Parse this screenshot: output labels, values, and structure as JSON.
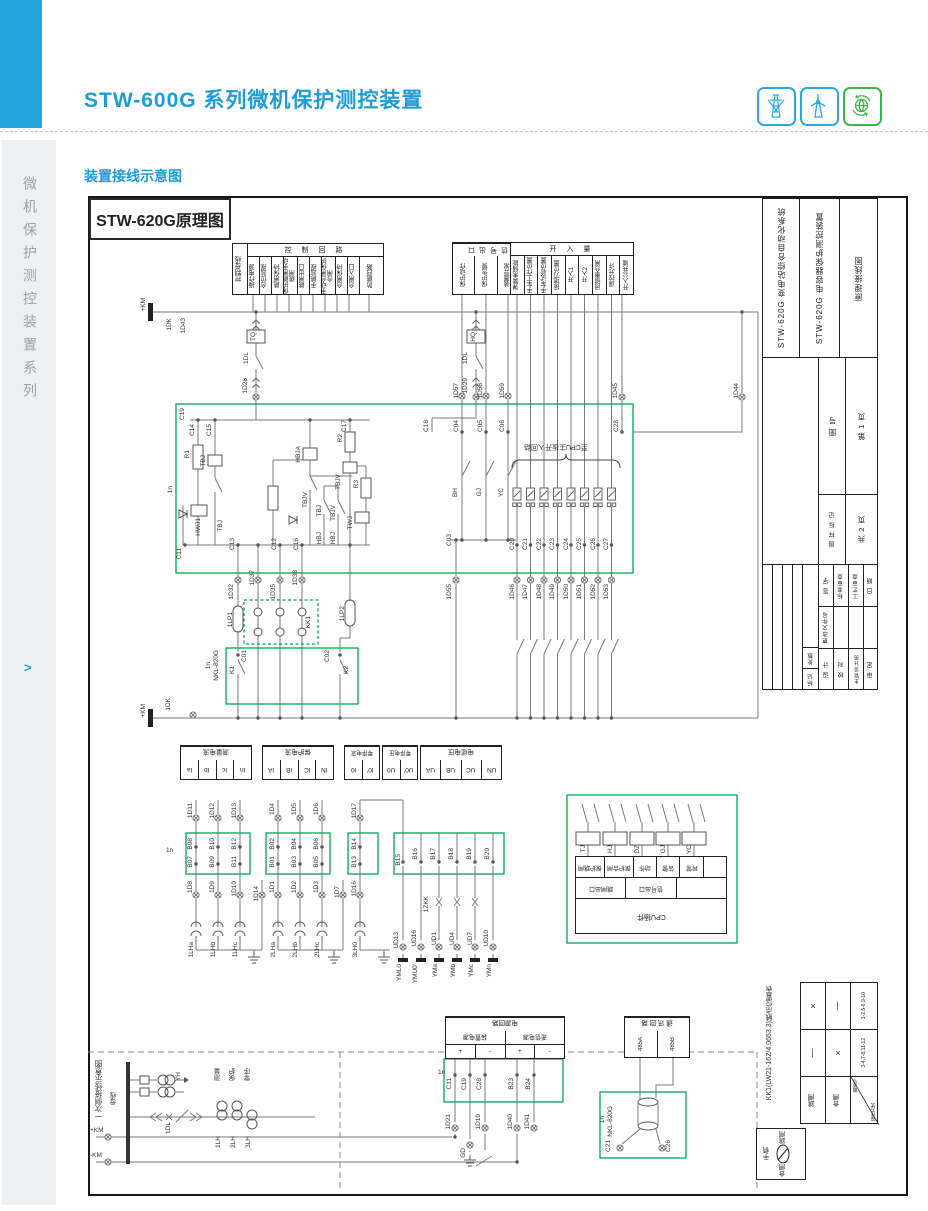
{
  "header": {
    "title": "STW-600G 系列微机保护测控装置",
    "section": "装置接线示意图",
    "sidebar": "微机保护测控装置系列",
    "sidebar_arrow": ">"
  },
  "diagram": {
    "title": "STW-620G原理图"
  },
  "ctrl_table": {
    "bus": "控制母线",
    "header": "控 制 回 路",
    "cols": [
      "操作电源",
      "合位监视",
      "跳闸保持",
      "保护跳闸手动跳闸",
      "跳闸出口",
      "手跳监视",
      "手动合闸保护合闸",
      "合闸保持",
      "合闸入口",
      "防跳回路"
    ]
  },
  "sig_table": {
    "header": "信号出口",
    "cols": [
      "保护动作",
      "保护告警",
      "装置异常"
    ]
  },
  "di_table": {
    "header": "开 入 量",
    "cols": [
      "弹簧未储能",
      "手车工作位置",
      "手车试验位置",
      "接地刀位置",
      "开入1",
      "开入2",
      "闭锁重合闸",
      "遥控允许",
      "开入公共端"
    ]
  },
  "analog_tables": [
    {
      "header": "测量电流",
      "cells": [
        "Ia",
        "Ib",
        "Ic",
        "In"
      ]
    },
    {
      "header": "保护电流",
      "cells": [
        "IA",
        "IB",
        "IC",
        "IN"
      ]
    },
    {
      "header": "零序电流",
      "cells": [
        "I0",
        "I0′"
      ]
    },
    {
      "header": "零序电压",
      "cells": [
        "U0",
        "U0′"
      ]
    },
    {
      "header": "电缆电压",
      "cells": [
        "UA",
        "UB",
        "UC",
        "UN"
      ]
    }
  ],
  "cpu_table": {
    "row1": [
      "保护跳闸",
      "保护合闸",
      "动作",
      "告警",
      "异常",
      ""
    ],
    "row2": [
      "跳闸出口",
      "信号出口",
      ""
    ],
    "row3": "CPU插件",
    "coils": [
      "TJ",
      "HJ",
      "DZ",
      "GJ",
      "YC"
    ],
    "note": "至CPU主板开入回路"
  },
  "power_table": {
    "header": "电源回路",
    "sub": [
      "装置电源",
      "遥信电源"
    ],
    "cells": [
      "+",
      "-",
      "+",
      "-"
    ]
  },
  "comm_table": {
    "header": "通 讯 回 路",
    "cells": [
      "485A",
      "485B"
    ]
  },
  "kk1": {
    "title": "KK1(LW21-16Z/4.0653.3)触点位置表",
    "contact_headers": [
      "1-2,5-6,9-10",
      "3-4,7-8,11-12"
    ],
    "marks": [
      [
        "×",
        "—"
      ],
      [
        "—",
        "×"
      ]
    ],
    "corner": [
      "触点号",
      "操作方式"
    ],
    "ops": [
      "跳闸",
      "合闸"
    ],
    "handle": [
      "跳闸",
      "合闸",
      "手柄"
    ]
  },
  "primary": {
    "title": "一次侧接线示意图",
    "bus": "母线",
    "pt": "YH",
    "breaker": "1DL",
    "groups": [
      "测量",
      "保护",
      "零序"
    ],
    "cts": [
      "1LH",
      "2LH",
      "3LH"
    ]
  },
  "titleblock": {
    "system": "STW-620G 变电站综合自动化系统",
    "device": "STW-620G 电容器保护测控装置",
    "doc": "原理接线图",
    "fig_no": "图  号",
    "page": "第 1 页",
    "mark": "图 样 标 记",
    "pages": "共 2 页",
    "sign": "签 字",
    "std": "标准审查",
    "craft": "工艺审查",
    "date2": "日 期",
    "change": "更改文件号",
    "count": "处数",
    "tag": "标记",
    "design": "设 计",
    "check": "校 对",
    "chief": "主管设计员",
    "approve": "审 定"
  },
  "labels": [
    {
      "t": "+KM",
      "x": 141,
      "y": 298,
      "r": 1
    },
    {
      "t": "1DK",
      "x": 167,
      "y": 318,
      "r": 1
    },
    {
      "t": "1D43",
      "x": 181,
      "y": 318,
      "r": 1
    },
    {
      "t": "TQ",
      "x": 251,
      "y": 332,
      "r": 1
    },
    {
      "t": "1DL",
      "x": 244,
      "y": 352,
      "r": 1
    },
    {
      "t": "1D26",
      "x": 243,
      "y": 378,
      "r": 1
    },
    {
      "t": "HQ",
      "x": 471,
      "y": 332,
      "r": 1
    },
    {
      "t": "1DL",
      "x": 463,
      "y": 352,
      "r": 1
    },
    {
      "t": "1D29",
      "x": 463,
      "y": 378,
      "r": 1
    },
    {
      "t": "1D57",
      "x": 454,
      "y": 383,
      "r": 1
    },
    {
      "t": "1D58",
      "x": 478,
      "y": 383,
      "r": 1
    },
    {
      "t": "1D59",
      "x": 500,
      "y": 383,
      "r": 1
    },
    {
      "t": "1D45",
      "x": 613,
      "y": 383,
      "r": 1
    },
    {
      "t": "1D44",
      "x": 734,
      "y": 383,
      "r": 1
    },
    {
      "t": "C19",
      "x": 180,
      "y": 408,
      "r": 1
    },
    {
      "t": "C14",
      "x": 190,
      "y": 424,
      "r": 1
    },
    {
      "t": "C15",
      "x": 207,
      "y": 424,
      "r": 1
    },
    {
      "t": "C18",
      "x": 424,
      "y": 420,
      "r": 1
    },
    {
      "t": "C17",
      "x": 342,
      "y": 420,
      "r": 1
    },
    {
      "t": "C04",
      "x": 454,
      "y": 420,
      "r": 1
    },
    {
      "t": "C05",
      "x": 478,
      "y": 420,
      "r": 1
    },
    {
      "t": "C06",
      "x": 500,
      "y": 420,
      "r": 1
    },
    {
      "t": "C28",
      "x": 614,
      "y": 420,
      "r": 1
    },
    {
      "t": "1n",
      "x": 168,
      "y": 486,
      "r": 1
    },
    {
      "t": "R1",
      "x": 185,
      "y": 450,
      "r": 1
    },
    {
      "t": "TBJ",
      "x": 201,
      "y": 455,
      "r": 1
    },
    {
      "t": "HWJ1",
      "x": 196,
      "y": 518,
      "r": 1
    },
    {
      "t": "TBJ",
      "x": 218,
      "y": 520,
      "r": 1
    },
    {
      "t": "HBJA",
      "x": 296,
      "y": 446,
      "r": 1
    },
    {
      "t": "R2",
      "x": 338,
      "y": 434,
      "r": 1
    },
    {
      "t": "TBJV",
      "x": 336,
      "y": 474,
      "r": 1
    },
    {
      "t": "TBJV",
      "x": 303,
      "y": 492,
      "r": 1
    },
    {
      "t": "R3",
      "x": 354,
      "y": 480,
      "r": 1
    },
    {
      "t": "TWJ",
      "x": 348,
      "y": 516,
      "r": 1
    },
    {
      "t": "TBJ",
      "x": 317,
      "y": 505,
      "r": 1
    },
    {
      "t": "TBJV",
      "x": 331,
      "y": 505,
      "r": 1
    },
    {
      "t": "HBJ",
      "x": 317,
      "y": 532,
      "r": 1
    },
    {
      "t": "HBJ",
      "x": 331,
      "y": 532,
      "r": 1
    },
    {
      "t": "C13",
      "x": 230,
      "y": 538,
      "r": 1
    },
    {
      "t": "C12",
      "x": 272,
      "y": 538,
      "r": 1
    },
    {
      "t": "C16",
      "x": 294,
      "y": 538,
      "r": 1
    },
    {
      "t": "C11",
      "x": 177,
      "y": 548,
      "r": 1
    },
    {
      "t": "BH",
      "x": 453,
      "y": 488,
      "r": 1
    },
    {
      "t": "GJ",
      "x": 477,
      "y": 488,
      "r": 1
    },
    {
      "t": "YC",
      "x": 499,
      "y": 488,
      "r": 1
    },
    {
      "t": "C03",
      "x": 447,
      "y": 534,
      "r": 1
    },
    {
      "t": "至CPU主板开入回路",
      "x": 524,
      "y": 443,
      "f": 1
    },
    {
      "t": "C20",
      "x": 510,
      "y": 538,
      "r": 1
    },
    {
      "t": "C21",
      "x": 523,
      "y": 538,
      "r": 1
    },
    {
      "t": "C22",
      "x": 537,
      "y": 538,
      "r": 1
    },
    {
      "t": "C23",
      "x": 550,
      "y": 538,
      "r": 1
    },
    {
      "t": "C24",
      "x": 564,
      "y": 538,
      "r": 1
    },
    {
      "t": "C25",
      "x": 577,
      "y": 538,
      "r": 1
    },
    {
      "t": "C26",
      "x": 591,
      "y": 538,
      "r": 1
    },
    {
      "t": "C27",
      "x": 604,
      "y": 538,
      "r": 1
    },
    {
      "t": "1D55",
      "x": 447,
      "y": 584,
      "r": 1
    },
    {
      "t": "1D46",
      "x": 510,
      "y": 584,
      "r": 1
    },
    {
      "t": "1D47",
      "x": 523,
      "y": 584,
      "r": 1
    },
    {
      "t": "1D48",
      "x": 537,
      "y": 584,
      "r": 1
    },
    {
      "t": "1D49",
      "x": 550,
      "y": 584,
      "r": 1
    },
    {
      "t": "1D50",
      "x": 564,
      "y": 584,
      "r": 1
    },
    {
      "t": "1D51",
      "x": 577,
      "y": 584,
      "r": 1
    },
    {
      "t": "1D52",
      "x": 591,
      "y": 584,
      "r": 1
    },
    {
      "t": "1D53",
      "x": 604,
      "y": 584,
      "r": 1
    },
    {
      "t": "1D32",
      "x": 229,
      "y": 584,
      "r": 1
    },
    {
      "t": "1D37",
      "x": 250,
      "y": 570,
      "r": 1
    },
    {
      "t": "1D35",
      "x": 271,
      "y": 584,
      "r": 1
    },
    {
      "t": "1D38",
      "x": 293,
      "y": 570,
      "r": 1
    },
    {
      "t": "1LP1",
      "x": 228,
      "y": 612,
      "r": 1
    },
    {
      "t": "KK1",
      "x": 306,
      "y": 616,
      "r": 1
    },
    {
      "t": "1LP2",
      "x": 340,
      "y": 606,
      "r": 1
    },
    {
      "t": "C01",
      "x": 242,
      "y": 650,
      "r": 1
    },
    {
      "t": "K1",
      "x": 230,
      "y": 666,
      "r": 1
    },
    {
      "t": "C02",
      "x": 325,
      "y": 650,
      "r": 1
    },
    {
      "t": "K2",
      "x": 344,
      "y": 666,
      "r": 1
    },
    {
      "t": "1n",
      "x": 206,
      "y": 662,
      "r": 1
    },
    {
      "t": "NKL-820G",
      "x": 214,
      "y": 650,
      "r": 1
    },
    {
      "t": "1DK",
      "x": 166,
      "y": 698,
      "r": 1
    },
    {
      "t": "+KM",
      "x": 141,
      "y": 704,
      "r": 1
    },
    {
      "t": "1n",
      "x": 166,
      "y": 848
    },
    {
      "t": "1D11",
      "x": 188,
      "y": 803,
      "r": 1
    },
    {
      "t": "1D12",
      "x": 210,
      "y": 803,
      "r": 1
    },
    {
      "t": "1D13",
      "x": 232,
      "y": 803,
      "r": 1
    },
    {
      "t": "B08",
      "x": 188,
      "y": 838,
      "r": 1
    },
    {
      "t": "B10",
      "x": 210,
      "y": 838,
      "r": 1
    },
    {
      "t": "B12",
      "x": 232,
      "y": 838,
      "r": 1
    },
    {
      "t": "B07",
      "x": 188,
      "y": 856,
      "r": 1
    },
    {
      "t": "B09",
      "x": 210,
      "y": 856,
      "r": 1
    },
    {
      "t": "B11",
      "x": 232,
      "y": 856,
      "r": 1
    },
    {
      "t": "1D8",
      "x": 188,
      "y": 881,
      "r": 1
    },
    {
      "t": "1D9",
      "x": 210,
      "y": 881,
      "r": 1
    },
    {
      "t": "1D10",
      "x": 232,
      "y": 881,
      "r": 1
    },
    {
      "t": "1D14",
      "x": 254,
      "y": 886,
      "r": 1
    },
    {
      "t": "1LHa",
      "x": 189,
      "y": 942,
      "r": 1
    },
    {
      "t": "1LHb",
      "x": 211,
      "y": 942,
      "r": 1
    },
    {
      "t": "1LHc",
      "x": 233,
      "y": 942,
      "r": 1
    },
    {
      "t": "1D4",
      "x": 270,
      "y": 803,
      "r": 1
    },
    {
      "t": "1D5",
      "x": 292,
      "y": 803,
      "r": 1
    },
    {
      "t": "1D6",
      "x": 314,
      "y": 803,
      "r": 1
    },
    {
      "t": "B02",
      "x": 270,
      "y": 838,
      "r": 1
    },
    {
      "t": "B04",
      "x": 292,
      "y": 838,
      "r": 1
    },
    {
      "t": "B06",
      "x": 314,
      "y": 838,
      "r": 1
    },
    {
      "t": "B01",
      "x": 270,
      "y": 856,
      "r": 1
    },
    {
      "t": "B03",
      "x": 292,
      "y": 856,
      "r": 1
    },
    {
      "t": "B05",
      "x": 314,
      "y": 856,
      "r": 1
    },
    {
      "t": "1D1",
      "x": 270,
      "y": 881,
      "r": 1
    },
    {
      "t": "1D2",
      "x": 292,
      "y": 881,
      "r": 1
    },
    {
      "t": "1D3",
      "x": 314,
      "y": 881,
      "r": 1
    },
    {
      "t": "1D7",
      "x": 335,
      "y": 886,
      "r": 1
    },
    {
      "t": "2LHa",
      "x": 271,
      "y": 942,
      "r": 1
    },
    {
      "t": "2LHb",
      "x": 293,
      "y": 942,
      "r": 1
    },
    {
      "t": "2LHc",
      "x": 315,
      "y": 942,
      "r": 1
    },
    {
      "t": "1D17",
      "x": 352,
      "y": 803,
      "r": 1
    },
    {
      "t": "B14",
      "x": 352,
      "y": 838,
      "r": 1
    },
    {
      "t": "B13",
      "x": 352,
      "y": 856,
      "r": 1
    },
    {
      "t": "1D16",
      "x": 352,
      "y": 881,
      "r": 1
    },
    {
      "t": "3LH0",
      "x": 353,
      "y": 942,
      "r": 1
    },
    {
      "t": "B15",
      "x": 396,
      "y": 854,
      "r": 1
    },
    {
      "t": "UD13",
      "x": 394,
      "y": 932,
      "r": 1
    },
    {
      "t": "YML0",
      "x": 397,
      "y": 964,
      "r": 1
    },
    {
      "t": "B16",
      "x": 413,
      "y": 848,
      "r": 1
    },
    {
      "t": "B17",
      "x": 431,
      "y": 848,
      "r": 1
    },
    {
      "t": "B18",
      "x": 449,
      "y": 848,
      "r": 1
    },
    {
      "t": "B19",
      "x": 467,
      "y": 848,
      "r": 1
    },
    {
      "t": "B20",
      "x": 485,
      "y": 848,
      "r": 1
    },
    {
      "t": "1ZKK",
      "x": 424,
      "y": 896,
      "r": 1
    },
    {
      "t": "UD16",
      "x": 412,
      "y": 930,
      "r": 1
    },
    {
      "t": "UD1",
      "x": 432,
      "y": 932,
      "r": 1
    },
    {
      "t": "UD4",
      "x": 450,
      "y": 932,
      "r": 1
    },
    {
      "t": "UD7",
      "x": 468,
      "y": 932,
      "r": 1
    },
    {
      "t": "UD10",
      "x": 484,
      "y": 930,
      "r": 1
    },
    {
      "t": "YMU0′",
      "x": 413,
      "y": 964,
      "r": 1
    },
    {
      "t": "YMa",
      "x": 433,
      "y": 964,
      "r": 1
    },
    {
      "t": "YMb",
      "x": 451,
      "y": 964,
      "r": 1
    },
    {
      "t": "YMc",
      "x": 469,
      "y": 964,
      "r": 1
    },
    {
      "t": "YMn",
      "x": 487,
      "y": 964,
      "r": 1
    },
    {
      "t": "1n",
      "x": 438,
      "y": 1070
    },
    {
      "t": "C11",
      "x": 447,
      "y": 1078,
      "r": 1
    },
    {
      "t": "C19",
      "x": 462,
      "y": 1078,
      "r": 1
    },
    {
      "t": "C28",
      "x": 477,
      "y": 1078,
      "r": 1
    },
    {
      "t": "B23",
      "x": 509,
      "y": 1078,
      "r": 1
    },
    {
      "t": "B24",
      "x": 526,
      "y": 1078,
      "r": 1
    },
    {
      "t": "1D21",
      "x": 446,
      "y": 1114,
      "r": 1
    },
    {
      "t": "1D19",
      "x": 476,
      "y": 1114,
      "r": 1
    },
    {
      "t": "GD",
      "x": 461,
      "y": 1148,
      "r": 1
    },
    {
      "t": "1D40",
      "x": 508,
      "y": 1114,
      "r": 1
    },
    {
      "t": "1D41",
      "x": 525,
      "y": 1114,
      "r": 1
    },
    {
      "t": "+KM",
      "x": 90,
      "y": 1128
    },
    {
      "t": "-KM",
      "x": 90,
      "y": 1153
    },
    {
      "t": "1n",
      "x": 600,
      "y": 1116,
      "r": 1
    },
    {
      "t": "NKL-820G",
      "x": 608,
      "y": 1106,
      "r": 1
    },
    {
      "t": "C21",
      "x": 606,
      "y": 1140,
      "r": 1
    },
    {
      "t": "C26",
      "x": 666,
      "y": 1140,
      "r": 1
    }
  ]
}
